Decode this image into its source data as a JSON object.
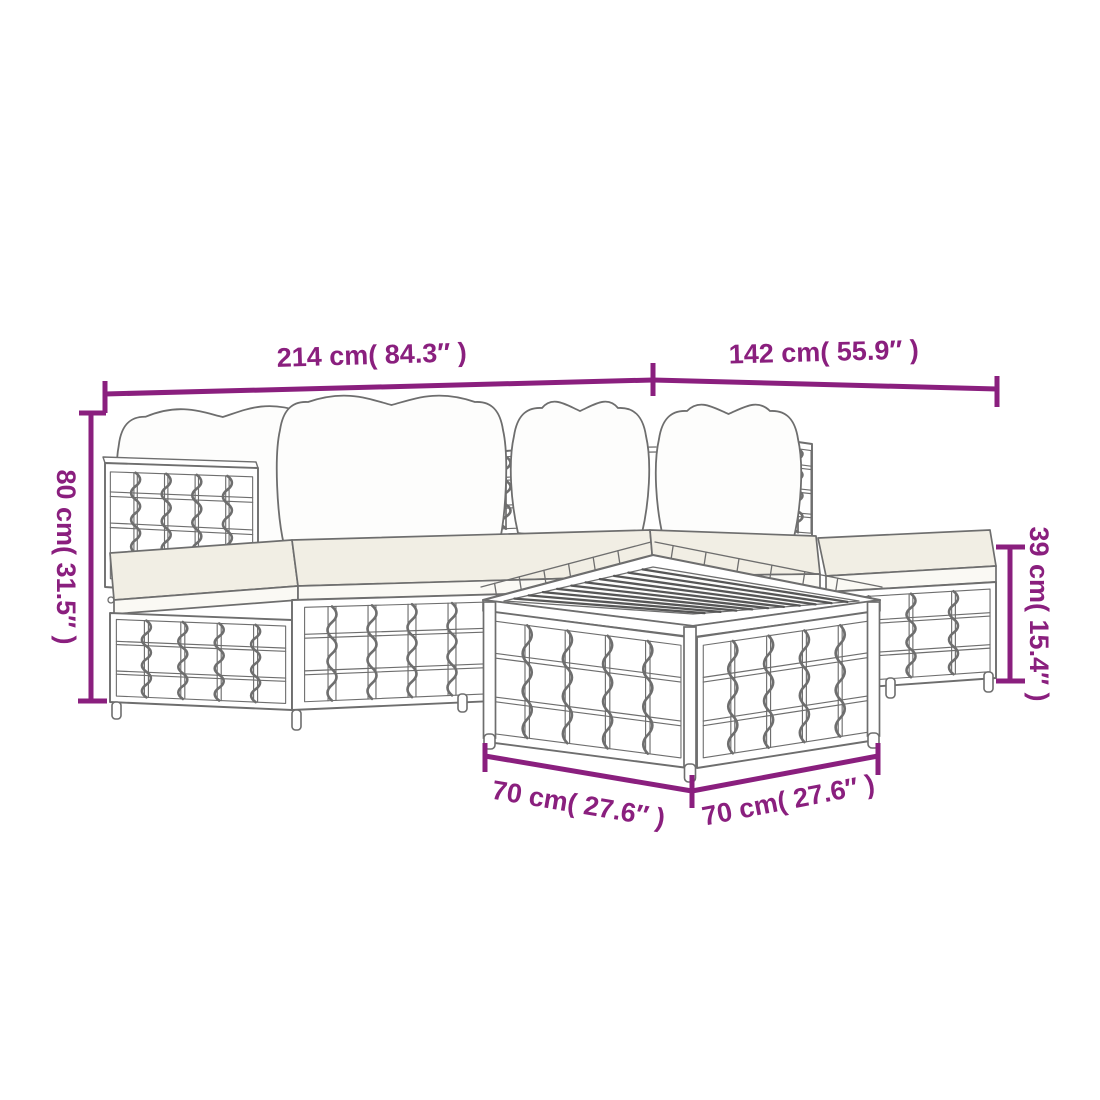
{
  "colors": {
    "accent": "#8a1f7e",
    "line": "#6e6e6e",
    "slat": "#565656",
    "cushion_top": "#f1eee4",
    "cushion_side": "#faf9f4",
    "back_cushion": "#fdfdfc"
  },
  "diagram": {
    "dimensions": {
      "sofa_total_length": {
        "display": "214 cm( 84.3″ )",
        "cm": 214,
        "inches": 84.3
      },
      "chaise_side_length": {
        "display": "142 cm( 55.9″ )",
        "cm": 142,
        "inches": 55.9
      },
      "back_height": {
        "display": "80 cm( 31.5″ )",
        "cm": 80,
        "inches": 31.5
      },
      "ottoman_height": {
        "display": "39 cm( 15.4″ )",
        "cm": 39,
        "inches": 15.4
      },
      "table_width": {
        "display": "70 cm( 27.6″ )",
        "cm": 70,
        "inches": 27.6
      },
      "table_depth": {
        "display": "70 cm( 27.6″ )",
        "cm": 70,
        "inches": 27.6
      }
    }
  }
}
